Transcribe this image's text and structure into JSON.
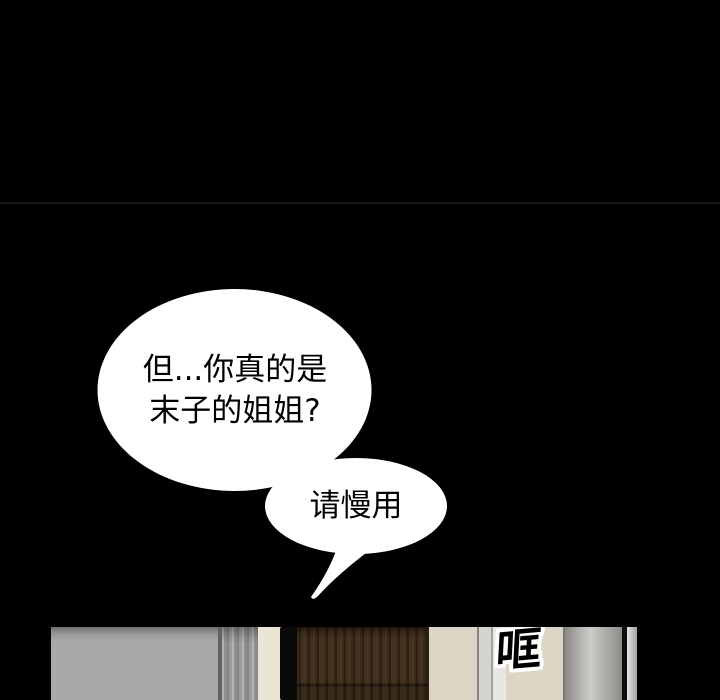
{
  "page": {
    "background": "#000000",
    "panel_divider_color": "#161616"
  },
  "speech_bubbles": [
    {
      "name": "question",
      "fill": "#ffffff",
      "text_color": "#000000",
      "lines": [
        "但...你真的是",
        "末子的姐姐?"
      ]
    },
    {
      "name": "reply",
      "fill": "#ffffff",
      "text_color": "#000000",
      "lines": [
        "请慢用"
      ]
    }
  ],
  "sfx": {
    "text": "哐",
    "fill": "#000000",
    "outline": "#ffffff"
  },
  "scene": {
    "colors": {
      "wall_gray": "#a9a9a9",
      "pillar_brushed_gray": "#8f8f8f",
      "wall_cream": "#ece6d8",
      "wall_beige": "#dcd5c5",
      "door_brown": "#3a2a1c",
      "metal_column_gray": "#cccbc8",
      "hardware_black": "#0a0a0a"
    }
  }
}
